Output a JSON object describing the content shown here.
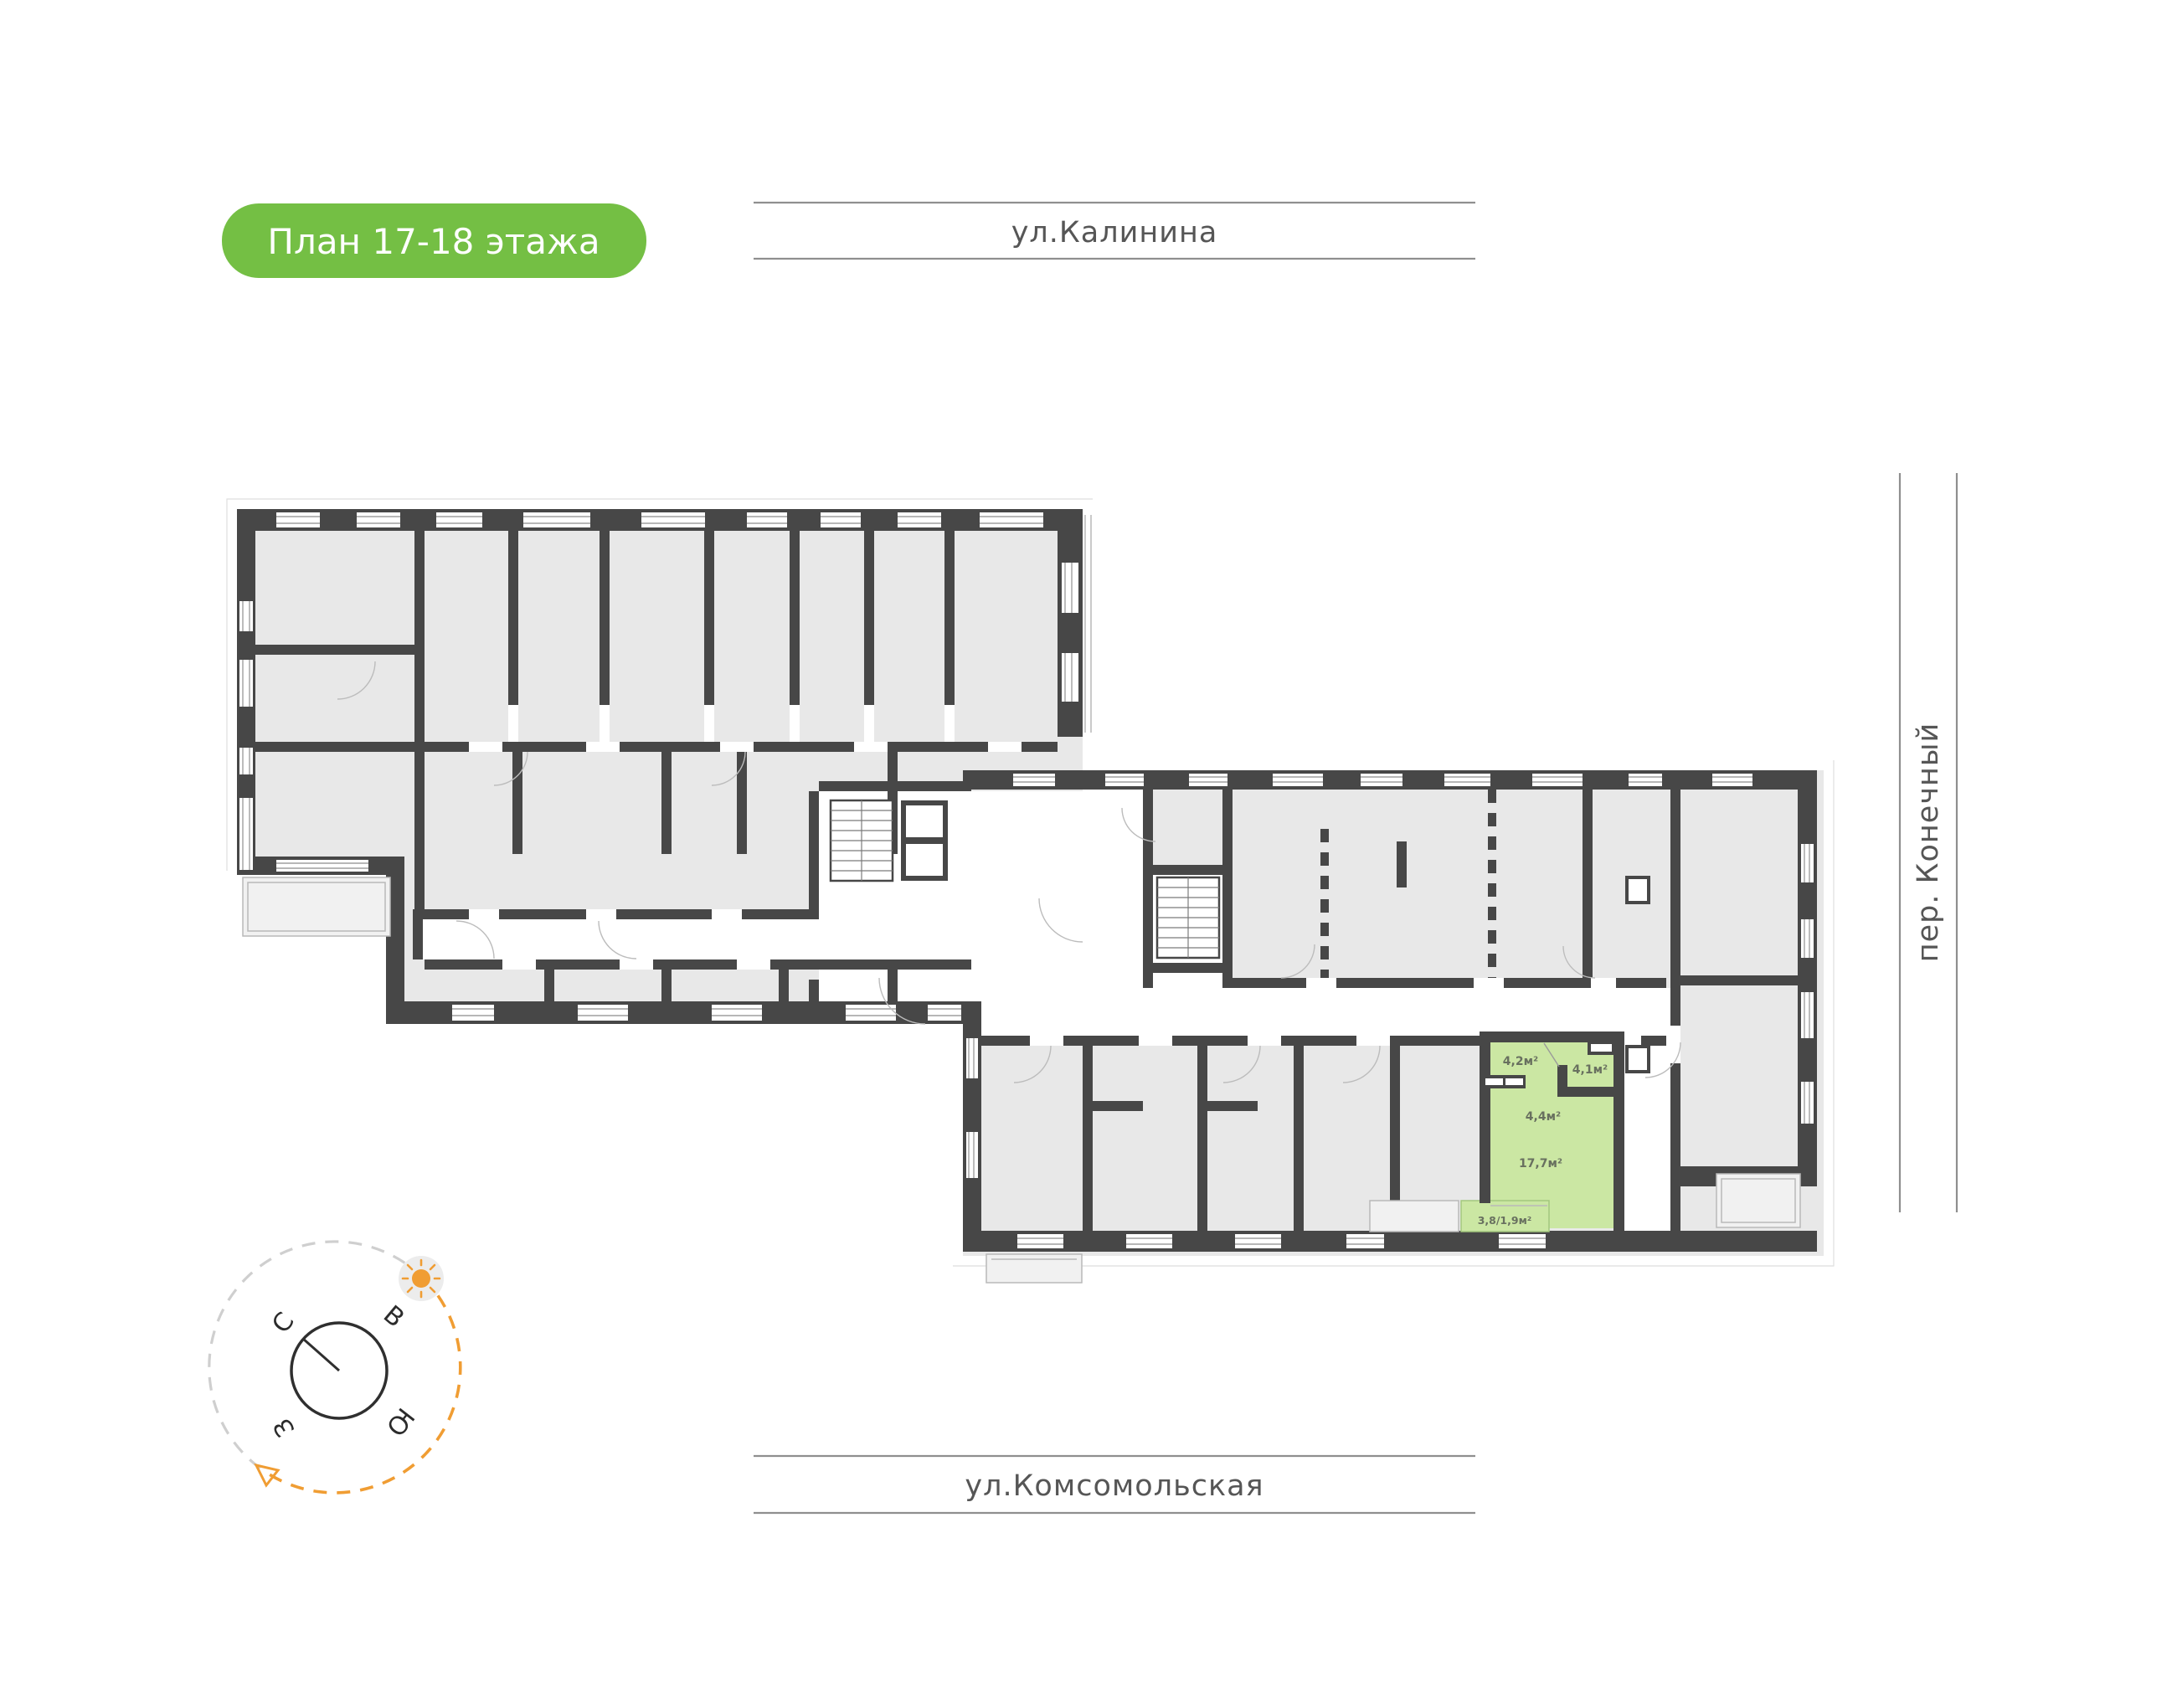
{
  "badge": {
    "label": "План 17-18 этажа",
    "bg_color": "#74bf44",
    "text_color": "#ffffff"
  },
  "streets": {
    "top": "ул.Калинина",
    "bottom": "ул.Комсомольская",
    "right": "пер. Конечный"
  },
  "compass": {
    "north": "С",
    "east": "В",
    "south": "Ю",
    "west": "З"
  },
  "plan": {
    "floors_label": "17-18",
    "apartment": {
      "highlight_color": "#cbe7a3",
      "rooms": [
        {
          "name": "hallway",
          "area": "4,2м²"
        },
        {
          "name": "bathroom",
          "area": "4,1м²"
        },
        {
          "name": "kitchen-niche",
          "area": "4,4м²"
        },
        {
          "name": "living-room",
          "area": "17,7м²"
        },
        {
          "name": "balcony",
          "area": "3,8/1,9м²"
        }
      ]
    },
    "colors": {
      "wall": "#474747",
      "room_fill": "#e8e8e8",
      "accent_green": "#74bf44",
      "apartment_green": "#cbe7a3",
      "label": "#68705f",
      "sun_orange": "#f09d33"
    }
  }
}
